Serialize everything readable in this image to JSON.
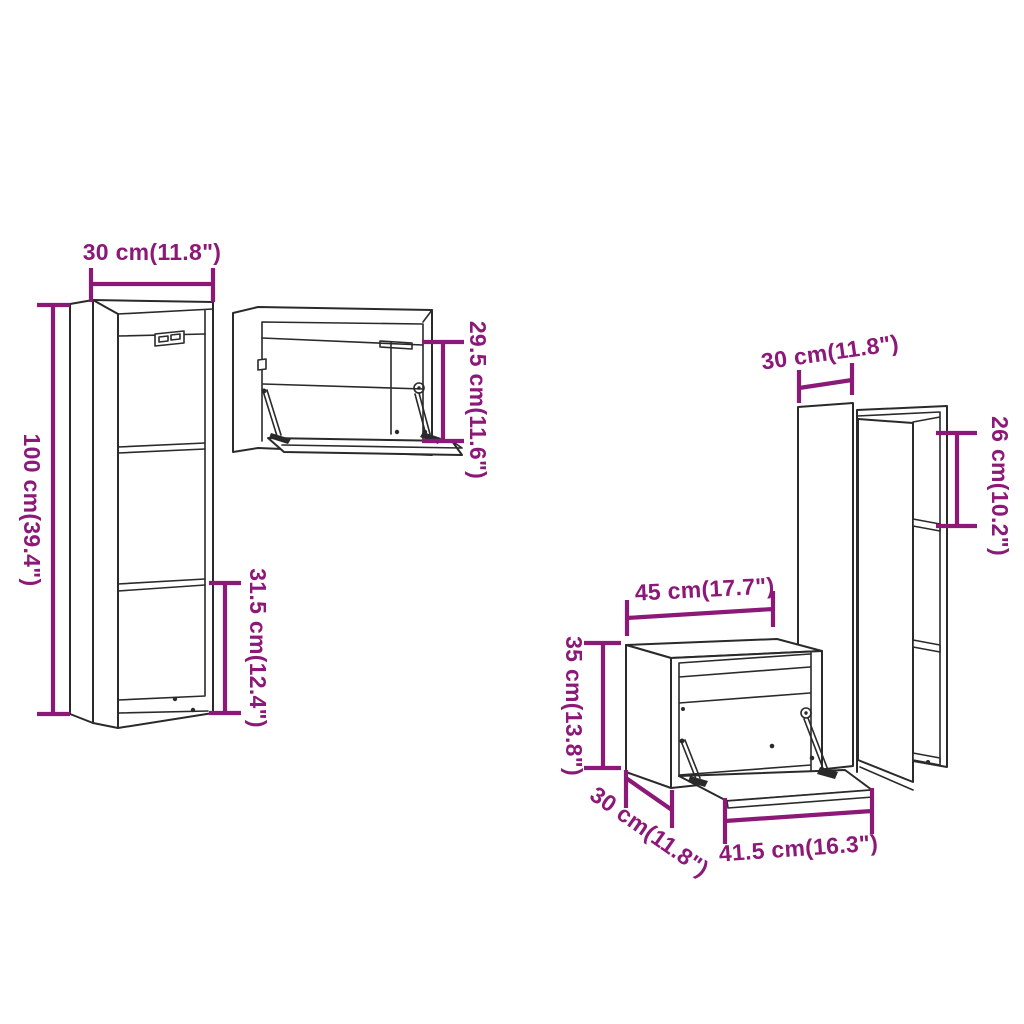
{
  "title": "Wall cabinet set dimension diagram (4 cabinets)",
  "colors": {
    "dimension_accent": "#8C1878",
    "drawing_line": "#2A2A2A",
    "background": "#FFFFFF"
  },
  "cabinets": [
    {
      "id": "tall-wall-cabinet-left",
      "annotations": {
        "width": "30 cm(11.8\")",
        "height": "100 cm(39.4\")",
        "bottom_section_height": "31.5 cm(12.4\")"
      }
    },
    {
      "id": "horizontal-wall-cabinet",
      "annotations": {
        "door_height": "29.5 cm(11.6\")"
      }
    },
    {
      "id": "tall-wall-cabinet-right",
      "annotations": {
        "width": "30 cm(11.8\")",
        "shelf_spacing": "26 cm(10.2\")"
      }
    },
    {
      "id": "flap-door-wall-cabinet",
      "annotations": {
        "width": "45 cm(17.7\")",
        "height": "35 cm(13.8\")",
        "depth": "30 cm(11.8\")",
        "flap_width": "41.5 cm(16.3\")"
      }
    }
  ]
}
